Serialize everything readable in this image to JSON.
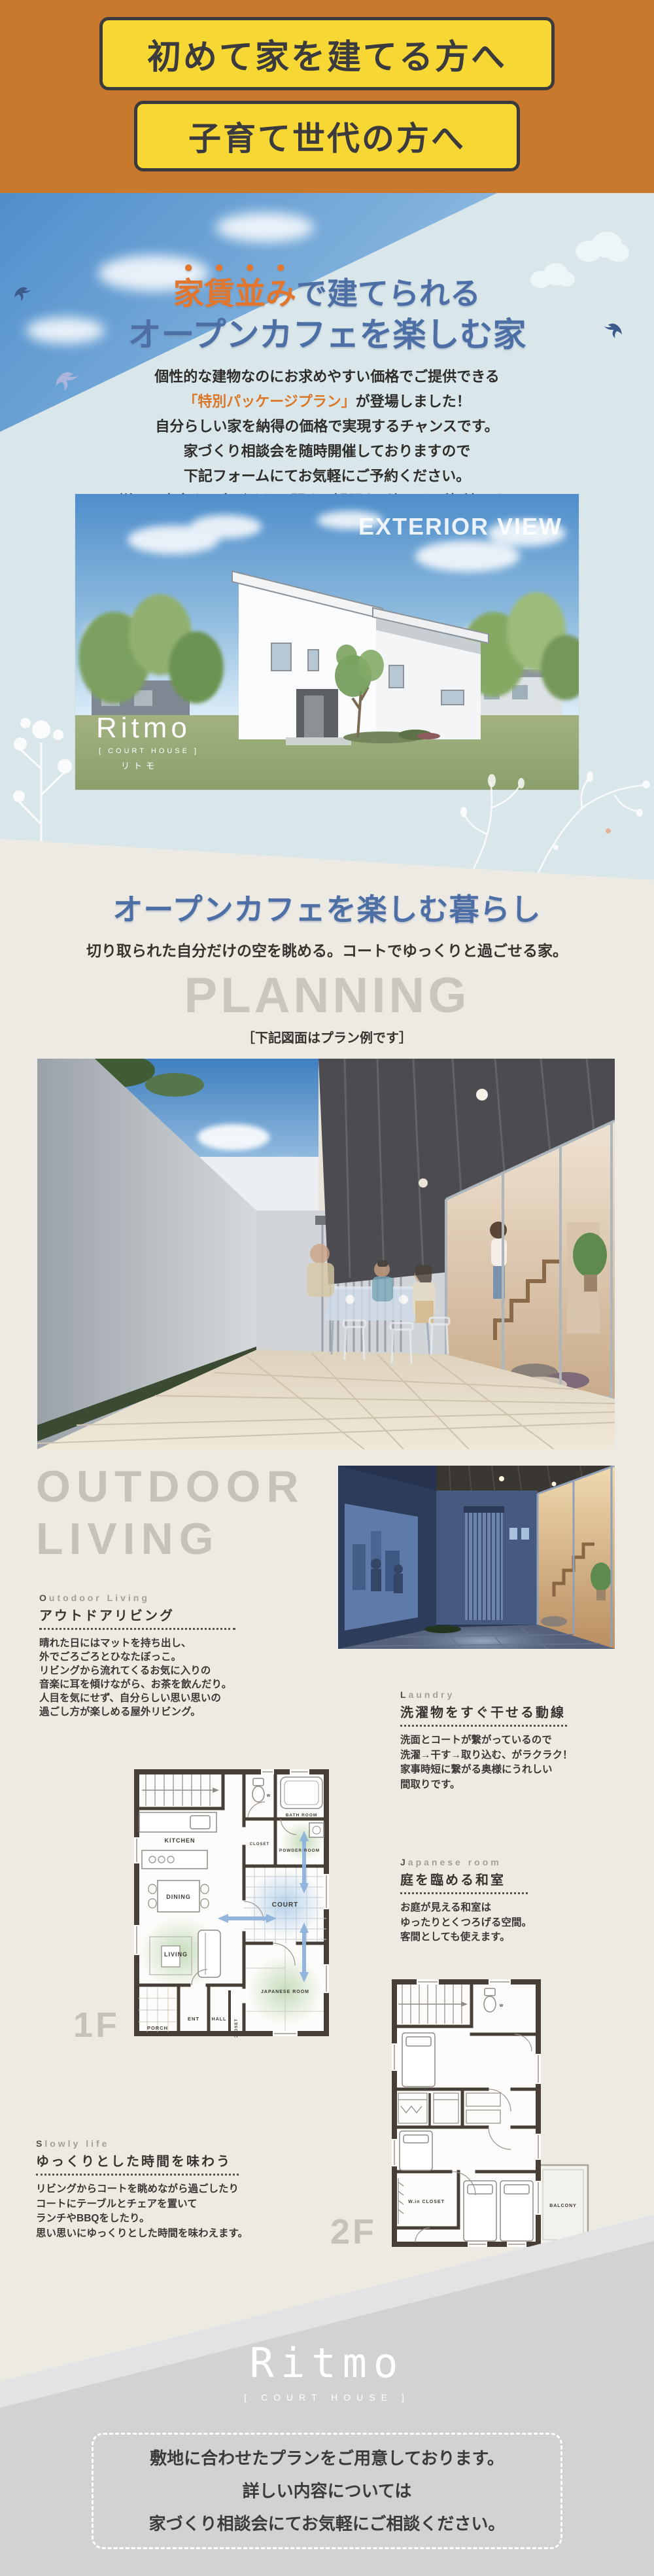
{
  "header": {
    "badge1": "初めて家を建てる方へ",
    "badge2": "子育て世代の方へ"
  },
  "hero": {
    "title1_accent": "家賃並み",
    "title1_rest": "で建てられる",
    "title2": "オープンカフェを楽しむ家",
    "p1": "個性的な建物なのにお求めやすい価格でご提供できる",
    "p2_accent": "「特別パッケージプラン」",
    "p2_rest": "が登場しました！",
    "p3": "自分らしい家を納得の価格で実現するチャンスです。",
    "p4": "家づくり相談会を随時開催しておりますので",
    "p5": "下記フォームにてお気軽にご予約ください。",
    "p6": "詳しい内容や、家づくりに関する疑問など何でもご相談下さい。"
  },
  "exterior": {
    "caption": "EXTERIOR VIEW",
    "logo": "Ritmo",
    "logo_sub": "[ COURT HOUSE ]",
    "logo_kana": "リトモ"
  },
  "lifestyle": {
    "title": "オープンカフェを楽しむ暮らし",
    "subtitle": "切り取られた自分だけの空を眺める。コートでゆっくりと過ごせる家。"
  },
  "planning": {
    "title": "PLANNING",
    "note": "［下記図面はプラン例です］"
  },
  "outdoor": {
    "big1": "OUTDOOR",
    "big2": "LIVING",
    "label": "Outodoor Living",
    "heading": "アウトドアリビング",
    "lines": [
      "晴れた日にはマットを持ち出し、",
      "外でごろごろとひなたぼっこ。",
      "リビングから流れてくるお気に入りの",
      "音楽に耳を傾けながら、お茶を飲んだり。",
      "人目を気にせず、自分らしい思い思いの",
      "過ごし方が楽しめる屋外リビング。"
    ]
  },
  "laundry": {
    "label": "Laundry",
    "heading": "洗濯物をすぐ干せる動線",
    "lines": [
      "洗面とコートが繋がっているので",
      "洗濯→干す→取り込む、がラクラク！",
      "家事時短に繋がる奥様にうれしい",
      "間取りです。"
    ]
  },
  "japanese": {
    "label": "Japanese room",
    "heading": "庭を臨める和室",
    "lines": [
      "お庭が見える和室は",
      "ゆったりとくつろげる空間。",
      "客間としても使えます。"
    ]
  },
  "slowly": {
    "label": "Slowly life",
    "heading": "ゆっくりとした時間を味わう",
    "lines": [
      "リビングからコートを眺めながら過ごしたり",
      "コートにテーブルとチェアを置いて",
      "ランチやBBQをしたり。",
      "思い思いにゆっくりとした時間を味わえます。"
    ]
  },
  "floorplan1": {
    "big_label": "1F",
    "rooms": {
      "kitchen": "KITCHEN",
      "dining": "DINING",
      "living": "LIVING",
      "porch": "PORCH",
      "ent": "ENT",
      "hall": "HALL",
      "closet_hall": "CLOSET",
      "bath": "BATH ROOM",
      "powder": "POWDER ROOM",
      "closet": "CLOSET",
      "court": "COURT",
      "japanese": "JAPANESE ROOM",
      "wc": "W"
    }
  },
  "floorplan2": {
    "big_label": "2F",
    "rooms": {
      "wic": "W.in CLOSET",
      "balcony": "BALCONY",
      "wc": "W"
    }
  },
  "footer": {
    "logo": "Ritmo",
    "logo_sub": "[ COURT HOUSE ]",
    "line1": "敷地に合わせたプランをご用意しております。",
    "line2": "詳しい内容については",
    "line3": "家づくり相談会にてお気軽にご相談ください。"
  },
  "colors": {
    "header_orange": "#c9792d",
    "badge_yellow": "#f6d733",
    "badge_border": "#3b3a3e",
    "hero_bg": "#d9e7ea",
    "accent_orange": "#e1762c",
    "heading_blue": "#4d6fa6",
    "beige_bg": "#edeae4",
    "gray_display": "#c5c2bc",
    "footer_gray": "#d2d2d5",
    "plan_wall": "#473f37",
    "plan_court_blue": "#a9c9e6",
    "plan_room_green": "#b7d4ab",
    "arrow_blue": "#8fb2dd"
  }
}
